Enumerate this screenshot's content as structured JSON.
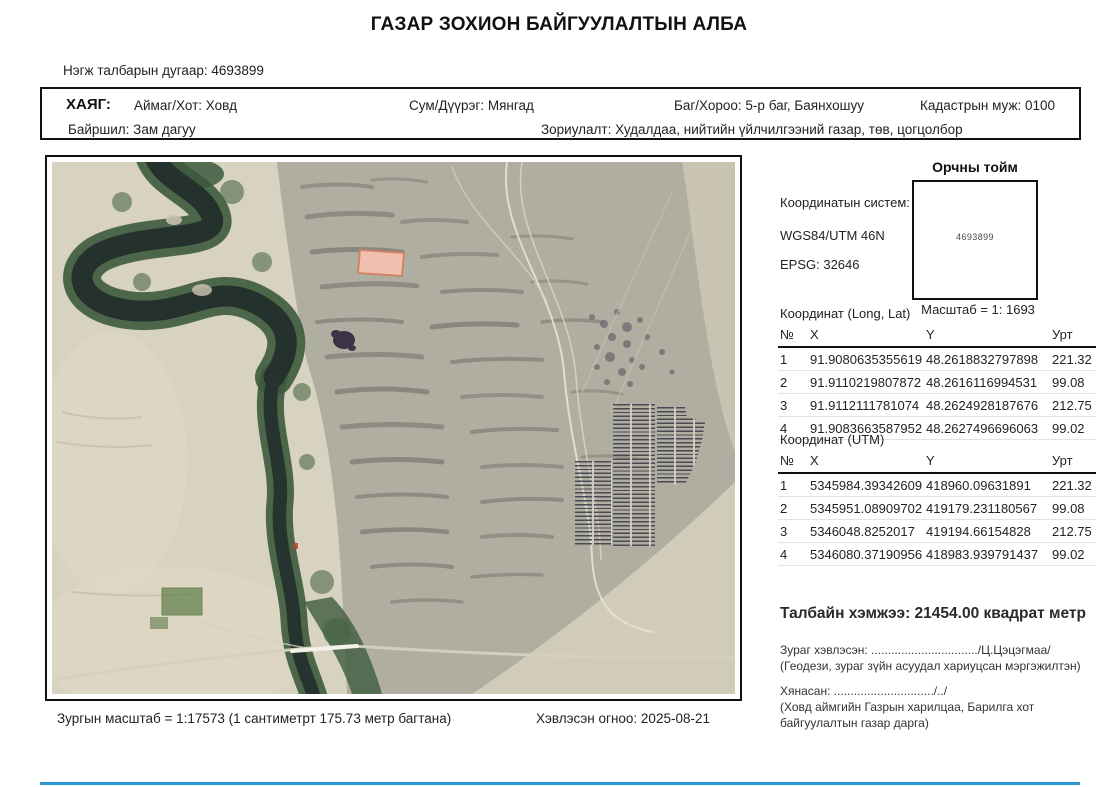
{
  "page": {
    "title": "ГАЗАР ЗОХИОН БАЙГУУЛАЛТЫН АЛБА",
    "parcel_number_line": "Нэгж талбарын дугаар: 4693899"
  },
  "address": {
    "label": "ХАЯГ:",
    "aimag": "Аймаг/Хот: Ховд",
    "sum": "Сум/Дүүрэг: Мянгад",
    "bag": "Баг/Хороо: 5-р баг, Баянхошуу",
    "cadastral": "Кадастрын муж: 0100",
    "location": "Байршил: Зам дагуу",
    "purpose": "Зориулалт: Худалдаа, нийтийн үйлчилгээний газар, төв, цогцолбор"
  },
  "panel": {
    "vicinity_title": "Орчны тойм",
    "vicinity_parcel_number": "4693899",
    "vicinity_scale": "Масштаб = 1: 1693",
    "coord_system_label": "Координатын систем:",
    "coord_system_value": "WGS84/UTM 46N",
    "epsg": "EPSG: 32646",
    "longlat_table": {
      "title": "Координат (Long, Lat)",
      "headers": [
        "№",
        "X",
        "Y",
        "Урт"
      ],
      "rows": [
        [
          "1",
          "91.9080635355619",
          "48.2618832797898",
          "221.32"
        ],
        [
          "2",
          "91.9110219807872",
          "48.2616116994531",
          "99.08"
        ],
        [
          "3",
          "91.9112111781074",
          "48.2624928187676",
          "212.75"
        ],
        [
          "4",
          "91.9083663587952",
          "48.2627496696063",
          "99.02"
        ]
      ]
    },
    "utm_table": {
      "title": "Координат (UTM)",
      "headers": [
        "№",
        "X",
        "Y",
        "Урт"
      ],
      "rows": [
        [
          "1",
          "5345984.39342609",
          "418960.09631891",
          "221.32"
        ],
        [
          "2",
          "5345951.08909702",
          "419179.231180567",
          "99.08"
        ],
        [
          "3",
          "5346048.8252017",
          "419194.66154828",
          "212.75"
        ],
        [
          "4",
          "5346080.37190956",
          "418983.939791437",
          "99.02"
        ]
      ]
    },
    "area_line": "Талбайн хэмжээ: 21454.00 квадрат метр",
    "printed_by_line": "Зураг хэвлэсэн: ................................/Ц.Цэцэгмаа/",
    "printed_by_role": "(Геодези, зураг зүйн асуудал хариуцсан мэргэжилтэн)",
    "reviewed_line": "Хянасан: ............................../../",
    "reviewed_role": "(Ховд аймгийн Газрын харилцаа, Барилга хот байгуулалтын газар дарга)"
  },
  "footer": {
    "map_scale": "Зургын масштаб = 1:17573 (1 сантиметрт 175.73 метр багтана)",
    "printed_date": "Хэвлэсэн огноо: 2025-08-21"
  },
  "map": {
    "colors": {
      "parcel_fill": "#f0bfae",
      "parcel_border": "#cf8166",
      "solar_line": "#4a4a55",
      "accent_bottom_line": "#2e9ad6"
    }
  }
}
